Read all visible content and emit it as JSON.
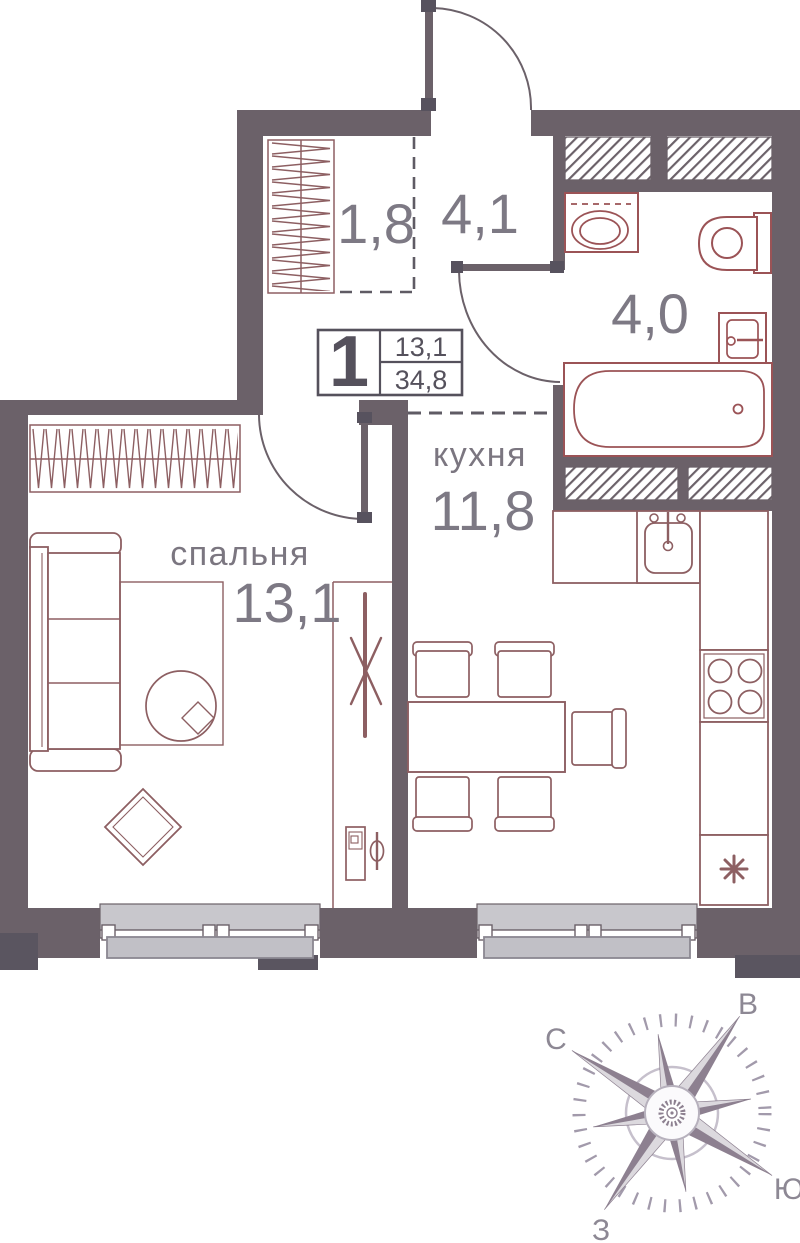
{
  "floorplan": {
    "badge": {
      "rooms_count": "1",
      "living_area": "13,1",
      "total_area": "34,8"
    },
    "rooms": {
      "closet": {
        "area": "1,8"
      },
      "hallway": {
        "area": "4,1"
      },
      "bathroom": {
        "area": "4,0"
      },
      "kitchen": {
        "label": "кухня",
        "area": "11,8"
      },
      "bedroom": {
        "label": "спальня",
        "area": "13,1"
      }
    },
    "compass": {
      "north": "С",
      "east": "В",
      "south": "Ю",
      "west": "З"
    },
    "icons": {
      "fridge_marker": "asterisk-icon",
      "vent_shaft": "diagonal-hatch",
      "wardrobe": "zigzag-hatch"
    },
    "colors": {
      "wall": "#6b6169",
      "wall_dark_step": "#5a5560",
      "furniture_outline": "#8d5f62",
      "fixture_outline": "#9b5356",
      "window_fill": "#c8c7cc",
      "window_fill_dark": "#c1c0c6",
      "text": "#7b7680",
      "badge_text": "#55515c",
      "compass_dark": "#8d8090",
      "compass_light": "#dcd9de"
    }
  }
}
